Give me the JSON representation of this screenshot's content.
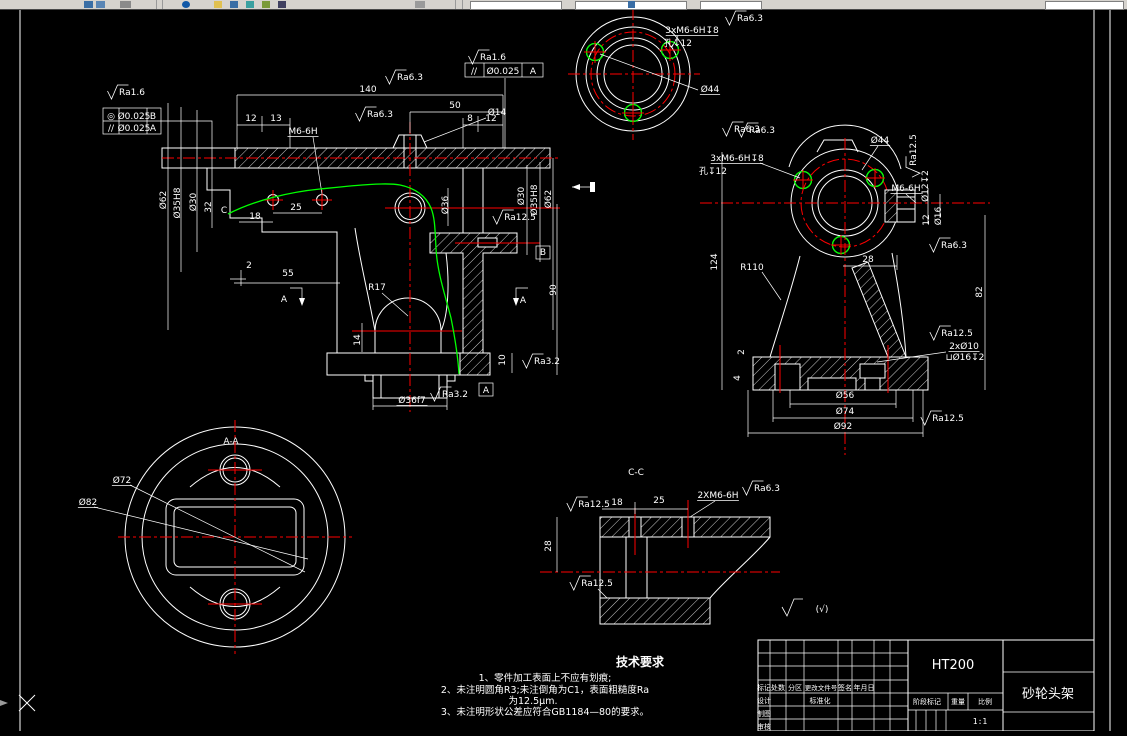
{
  "app": {
    "background": "#000000",
    "line_color": "#ffffff",
    "centerline_color": "#ff0000",
    "highlight_color": "#00ff00",
    "toolbar_color": "#d6d3ce"
  },
  "title_block": {
    "material": "HT200",
    "part_name": "砂轮头架",
    "scale_value": "1:1",
    "header_row": [
      "标记",
      "处数",
      "分区",
      "更改文件号",
      "签名",
      "年月日"
    ],
    "design_label": "设计",
    "draft_label": "制图",
    "check_label": "审核",
    "std_label": "标准化",
    "stage_label": "阶段标记",
    "weight_label": "重量",
    "scale_label": "比例"
  },
  "tech_requirements": {
    "title": "技术要求",
    "lines": [
      "1、零件加工表面上不应有划痕;",
      "2、未注明圆角R3;未注倒角为C1，表面粗糙度Ra",
      "为12.5μm.",
      "3、未注明形状公差应符合GB1184—80的要求。"
    ]
  },
  "annotations": [
    {
      "n": "thread-callout-top-view",
      "t": "3xM6-6H↧8",
      "x": 692,
      "y": 33,
      "u": 1
    },
    {
      "n": "hole-depth-top-view",
      "t": "孔↧12",
      "x": 678,
      "y": 46
    },
    {
      "n": "dim-d44-top",
      "t": "Ø44",
      "x": 710,
      "y": 92,
      "u": 1
    },
    {
      "n": "roughness-top-1",
      "t": "Ra6.3",
      "x": 750,
      "y": 21,
      "sym": 1
    },
    {
      "n": "roughness-top-2",
      "t": "Ra6.3",
      "x": 762,
      "y": 133,
      "sym": 1
    },
    {
      "n": "roughness-front-1",
      "t": "Ra1.6",
      "x": 132,
      "y": 95,
      "sym": 1
    },
    {
      "n": "tol-sym-1",
      "t": "◎",
      "x": 111,
      "y": 119
    },
    {
      "n": "tol-val-1",
      "t": "Ø0.025",
      "x": 134,
      "y": 119
    },
    {
      "n": "tol-datum-1",
      "t": "B",
      "x": 153,
      "y": 119
    },
    {
      "n": "tol-sym-2",
      "t": "//",
      "x": 111,
      "y": 131
    },
    {
      "n": "tol-val-2",
      "t": "Ø0.025",
      "x": 134,
      "y": 131
    },
    {
      "n": "tol-datum-2",
      "t": "A",
      "x": 153,
      "y": 131
    },
    {
      "n": "dim-140",
      "t": "140",
      "x": 368,
      "y": 92
    },
    {
      "n": "roughness-front-2",
      "t": "Ra6.3",
      "x": 410,
      "y": 80,
      "sym": 1
    },
    {
      "n": "roughness-front-3",
      "t": "Ra1.6",
      "x": 493,
      "y": 60,
      "sym": 1
    },
    {
      "n": "tol-sym-3",
      "t": "//",
      "x": 474,
      "y": 74
    },
    {
      "n": "tol-val-3",
      "t": "Ø0.025",
      "x": 503,
      "y": 74
    },
    {
      "n": "tol-datum-3",
      "t": "A",
      "x": 533,
      "y": 74
    },
    {
      "n": "dim-50",
      "t": "50",
      "x": 455,
      "y": 108
    },
    {
      "n": "dim-12a",
      "t": "12",
      "x": 251,
      "y": 121
    },
    {
      "n": "dim-13",
      "t": "13",
      "x": 276,
      "y": 121
    },
    {
      "n": "thread-callout-front",
      "t": "M6-6H",
      "x": 303,
      "y": 134,
      "u": 1
    },
    {
      "n": "roughness-front-4",
      "t": "Ra6.3",
      "x": 380,
      "y": 117,
      "sym": 1
    },
    {
      "n": "dim-d14",
      "t": "Ø14",
      "x": 497,
      "y": 115
    },
    {
      "n": "dim-8",
      "t": "8",
      "x": 470,
      "y": 121
    },
    {
      "n": "dim-12b",
      "t": "12",
      "x": 491,
      "y": 121
    },
    {
      "n": "dim-d62-left",
      "t": "Ø62",
      "x": 166,
      "y": 200,
      "r": 1
    },
    {
      "n": "dim-d35h8-left",
      "t": "Ø35H8",
      "x": 180,
      "y": 203,
      "r": 1
    },
    {
      "n": "dim-d30-left",
      "t": "Ø30",
      "x": 196,
      "y": 202,
      "r": 1
    },
    {
      "n": "dim-32",
      "t": "32",
      "x": 211,
      "y": 207,
      "r": 1
    },
    {
      "n": "label-c",
      "t": "C",
      "x": 224,
      "y": 213,
      "s": 11
    },
    {
      "n": "dim-18",
      "t": "18",
      "x": 255,
      "y": 219
    },
    {
      "n": "dim-25",
      "t": "25",
      "x": 296,
      "y": 210
    },
    {
      "n": "dim-2",
      "t": "2",
      "x": 249,
      "y": 268
    },
    {
      "n": "dim-55",
      "t": "55",
      "x": 288,
      "y": 276
    },
    {
      "n": "dim-r17",
      "t": "R17",
      "x": 377,
      "y": 290
    },
    {
      "n": "dim-14",
      "t": "14",
      "x": 360,
      "y": 340,
      "r": 1
    },
    {
      "n": "dim-d36f7",
      "t": "Ø36f7",
      "x": 412,
      "y": 403,
      "u": 1
    },
    {
      "n": "roughness-front-5",
      "t": "Ra3.2",
      "x": 455,
      "y": 397,
      "sym": 1
    },
    {
      "n": "roughness-front-6",
      "t": "Ra3.2",
      "x": 547,
      "y": 364,
      "sym": 1
    },
    {
      "n": "dim-10",
      "t": "10",
      "x": 505,
      "y": 360,
      "r": 1
    },
    {
      "n": "dim-d36",
      "t": "Ø36",
      "x": 448,
      "y": 205,
      "r": 1
    },
    {
      "n": "dim-d30-right",
      "t": "Ø30",
      "x": 524,
      "y": 196,
      "r": 1
    },
    {
      "n": "dim-d35h8-right",
      "t": "Ø35H8",
      "x": 537,
      "y": 200,
      "r": 1
    },
    {
      "n": "dim-d62-right",
      "t": "Ø62",
      "x": 551,
      "y": 199,
      "r": 1
    },
    {
      "n": "dim-90",
      "t": "90",
      "x": 556,
      "y": 290,
      "r": 1
    },
    {
      "n": "roughness-front-7",
      "t": "Ra12.5",
      "x": 520,
      "y": 220,
      "sym": 1
    },
    {
      "n": "section-a-left",
      "t": "A",
      "x": 284,
      "y": 302,
      "s": 11
    },
    {
      "n": "section-a-right",
      "t": "A",
      "x": 523,
      "y": 303,
      "s": 11
    },
    {
      "n": "section-a-box",
      "t": "A",
      "x": 486,
      "y": 393,
      "s": 10
    },
    {
      "n": "datum-b-box",
      "t": "B",
      "x": 543,
      "y": 255,
      "s": 10
    },
    {
      "n": "roughness-side-1",
      "t": "Ra6.3",
      "x": 747,
      "y": 132,
      "sym": 1
    },
    {
      "n": "thread-callout-side",
      "t": "3xM6-6H↧8",
      "x": 737,
      "y": 161,
      "u": 1
    },
    {
      "n": "hole-depth-side",
      "t": "孔↧12",
      "x": 713,
      "y": 174
    },
    {
      "n": "dim-d44-side",
      "t": "Ø44",
      "x": 880,
      "y": 143,
      "u": 1
    },
    {
      "n": "roughness-side-2",
      "t": "Ra12.5",
      "x": 916,
      "y": 150,
      "r": 1,
      "sym": 1
    },
    {
      "n": "dim-d12-depth",
      "t": "Ø12↧2",
      "x": 928,
      "y": 186,
      "r": 1
    },
    {
      "n": "thread-callout-boss",
      "t": "M6-6H",
      "x": 906,
      "y": 191,
      "u": 1
    },
    {
      "n": "dim-12c",
      "t": "12",
      "x": 929,
      "y": 220,
      "r": 1
    },
    {
      "n": "dim-d16",
      "t": "Ø16",
      "x": 941,
      "y": 216,
      "r": 1
    },
    {
      "n": "roughness-side-3",
      "t": "Ra6.3",
      "x": 954,
      "y": 248,
      "sym": 1
    },
    {
      "n": "dim-28-side",
      "t": "28",
      "x": 868,
      "y": 262
    },
    {
      "n": "dim-r110",
      "t": "R110",
      "x": 752,
      "y": 270
    },
    {
      "n": "dim-124",
      "t": "124",
      "x": 717,
      "y": 262,
      "r": 1
    },
    {
      "n": "dim-82",
      "t": "82",
      "x": 982,
      "y": 292,
      "r": 1
    },
    {
      "n": "roughness-side-4",
      "t": "Ra12.5",
      "x": 957,
      "y": 336,
      "sym": 1
    },
    {
      "n": "dim-2xd10",
      "t": "2xØ10",
      "x": 964,
      "y": 349,
      "u": 1
    },
    {
      "n": "dim-spotface",
      "t": "⊔Ø16↧2",
      "x": 965,
      "y": 360
    },
    {
      "n": "dim-2-side",
      "t": "2",
      "x": 744,
      "y": 352,
      "r": 1
    },
    {
      "n": "dim-4-side",
      "t": "4",
      "x": 740,
      "y": 378,
      "r": 1
    },
    {
      "n": "dim-d56",
      "t": "Ø56",
      "x": 845,
      "y": 398
    },
    {
      "n": "dim-d74",
      "t": "Ø74",
      "x": 845,
      "y": 414
    },
    {
      "n": "dim-d92",
      "t": "Ø92",
      "x": 843,
      "y": 429
    },
    {
      "n": "roughness-side-5",
      "t": "Ra12.5",
      "x": 948,
      "y": 421,
      "sym": 1
    },
    {
      "n": "label-section-aa",
      "t": "A-A",
      "x": 231,
      "y": 444,
      "s": 11
    },
    {
      "n": "dim-d72",
      "t": "Ø72",
      "x": 122,
      "y": 483,
      "u": 1
    },
    {
      "n": "dim-d82",
      "t": "Ø82",
      "x": 88,
      "y": 505,
      "u": 1
    },
    {
      "n": "label-section-cc",
      "t": "C-C",
      "x": 636,
      "y": 475,
      "s": 11
    },
    {
      "n": "roughness-cc-1",
      "t": "Ra12.5",
      "x": 594,
      "y": 507,
      "sym": 1
    },
    {
      "n": "dim-18-cc",
      "t": "18",
      "x": 617,
      "y": 505
    },
    {
      "n": "dim-25-cc",
      "t": "25",
      "x": 659,
      "y": 503
    },
    {
      "n": "thread-callout-cc",
      "t": "2XM6-6H",
      "x": 718,
      "y": 498,
      "u": 1
    },
    {
      "n": "roughness-cc-2",
      "t": "Ra6.3",
      "x": 767,
      "y": 491,
      "sym": 1
    },
    {
      "n": "dim-28-cc",
      "t": "28",
      "x": 551,
      "y": 546,
      "r": 1
    },
    {
      "n": "roughness-cc-3",
      "t": "Ra12.5",
      "x": 597,
      "y": 586,
      "sym": 1
    },
    {
      "n": "rest-roughness-parens",
      "t": "(√)",
      "x": 822,
      "y": 612,
      "s": 12
    }
  ]
}
